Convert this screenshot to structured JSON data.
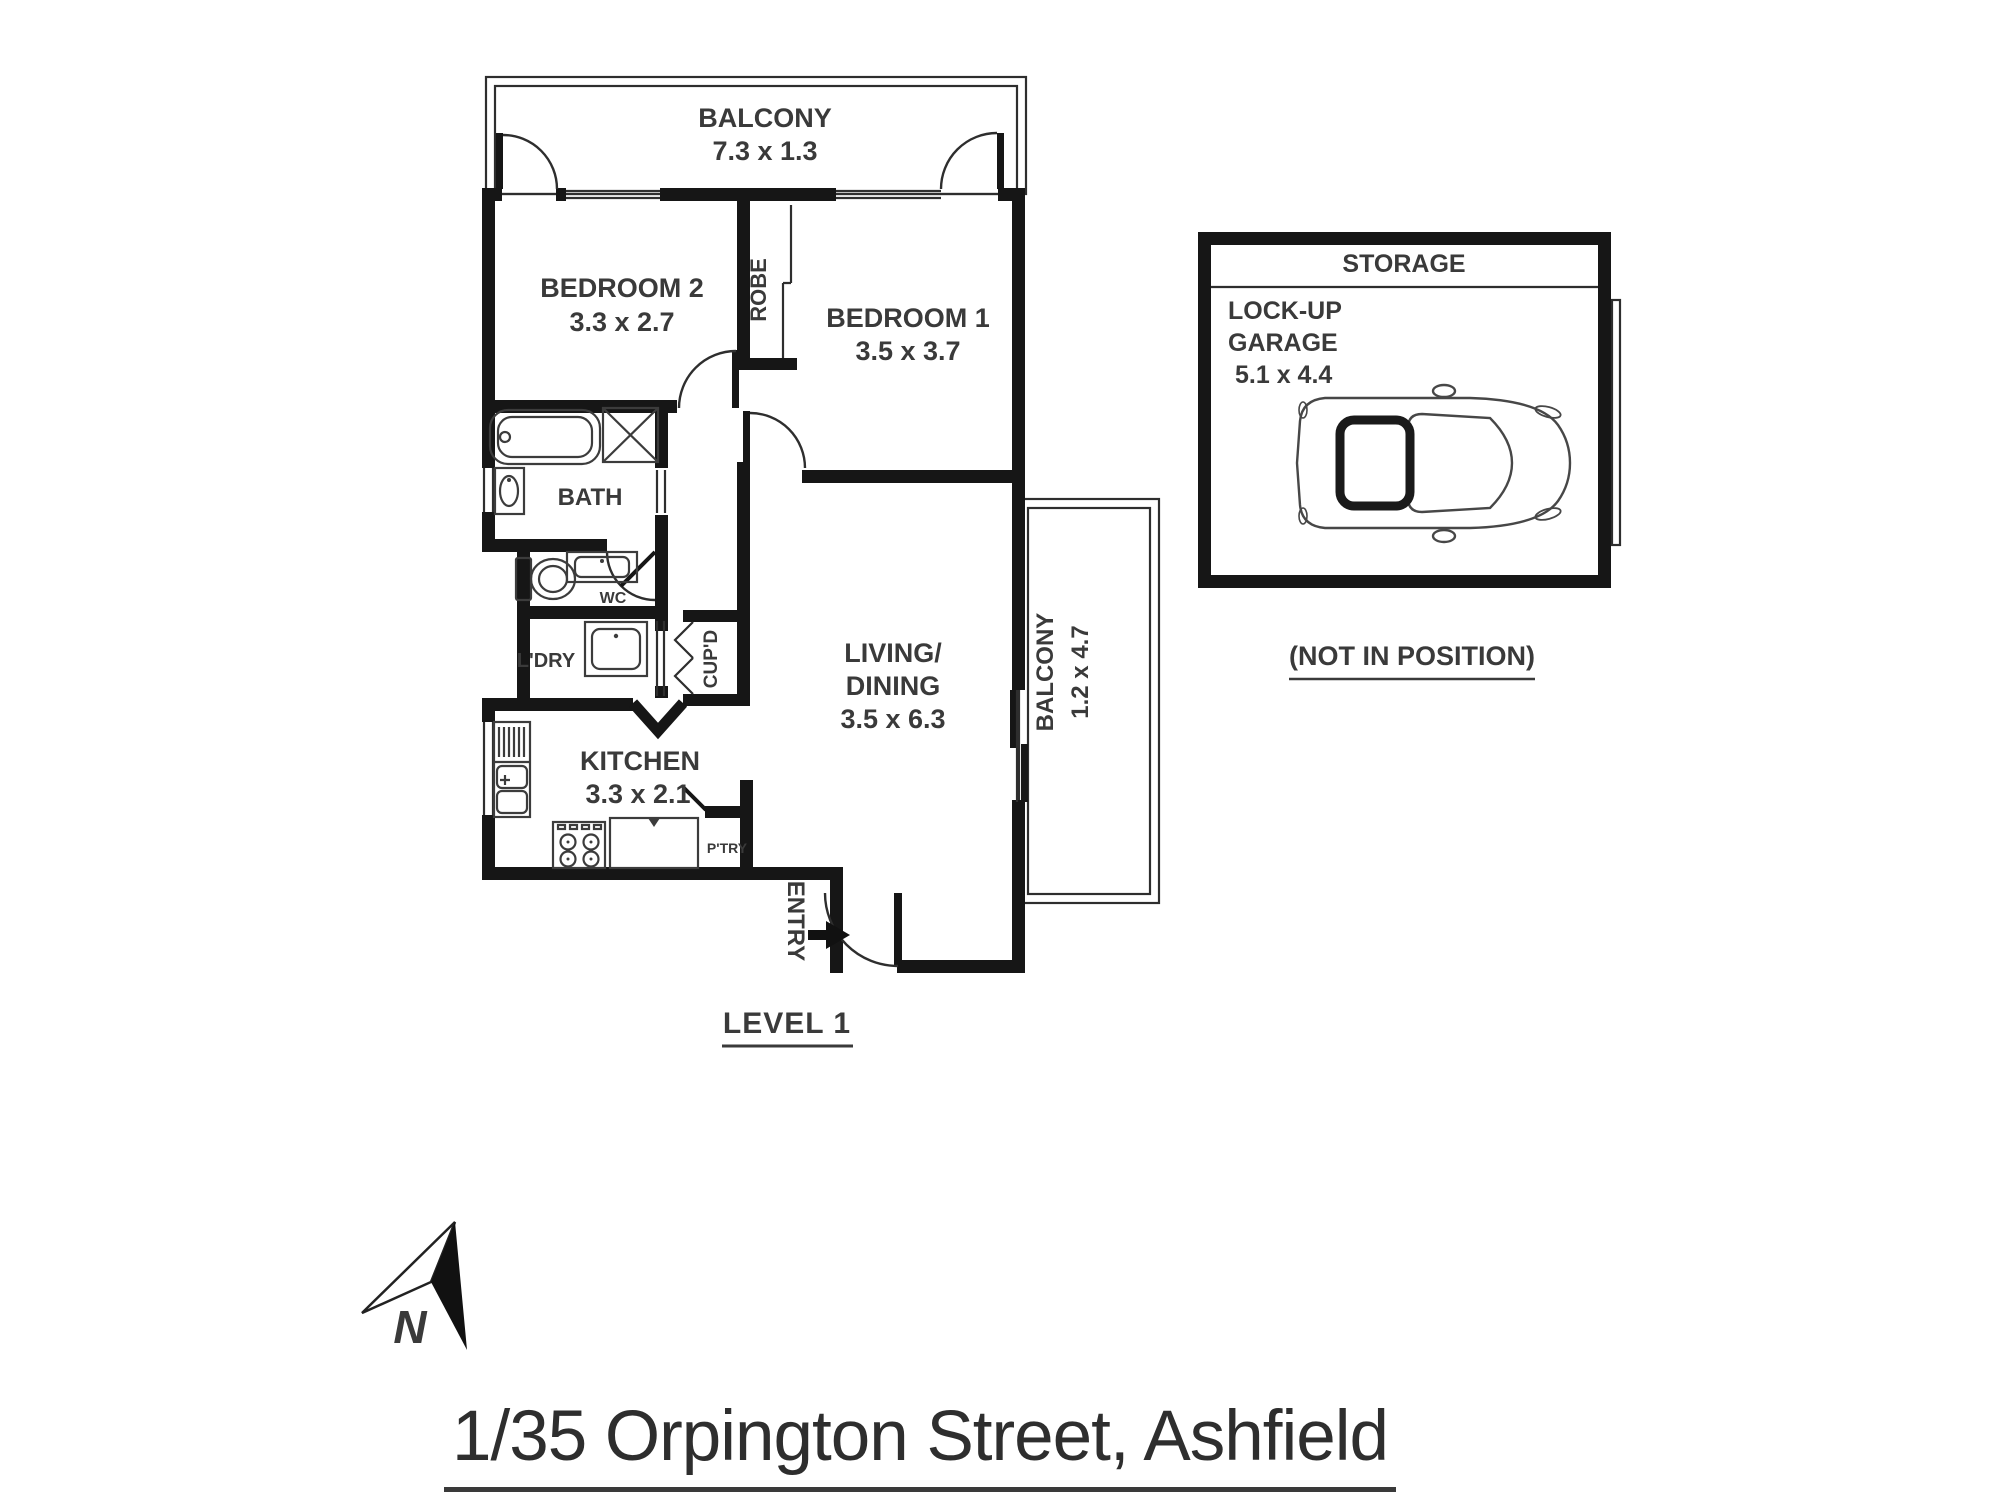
{
  "floorplan": {
    "level_label": "LEVEL 1",
    "balcony_top": {
      "name": "BALCONY",
      "dims": "7.3 x 1.3"
    },
    "bedroom2": {
      "name": "BEDROOM 2",
      "dims": "3.3 x 2.7"
    },
    "robe": {
      "name": "ROBE"
    },
    "bedroom1": {
      "name": "BEDROOM 1",
      "dims": "3.5 x 3.7"
    },
    "bath": {
      "name": "BATH"
    },
    "wc": {
      "name": "WC"
    },
    "laundry": {
      "name": "L'DRY"
    },
    "cupboard": {
      "name": "CUP'D"
    },
    "kitchen": {
      "name": "KITCHEN",
      "dims": "3.3 x 2.1"
    },
    "pantry": {
      "name": "P'TRY"
    },
    "living": {
      "line1": "LIVING/",
      "line2": "DINING",
      "dims": "3.5 x 6.3"
    },
    "balcony_side": {
      "name": "BALCONY",
      "dims": "1.2 x 4.7"
    },
    "entry": {
      "name": "ENTRY"
    }
  },
  "garage": {
    "storage": "STORAGE",
    "line1": "LOCK-UP",
    "line2": "GARAGE",
    "dims": "5.1 x 4.4",
    "note": "(NOT IN POSITION)"
  },
  "compass": {
    "north": "N"
  },
  "address": "1/35 Orpington Street, Ashfield",
  "colors": {
    "wall": "#161616",
    "text": "#3a3a3a",
    "background": "#ffffff"
  }
}
